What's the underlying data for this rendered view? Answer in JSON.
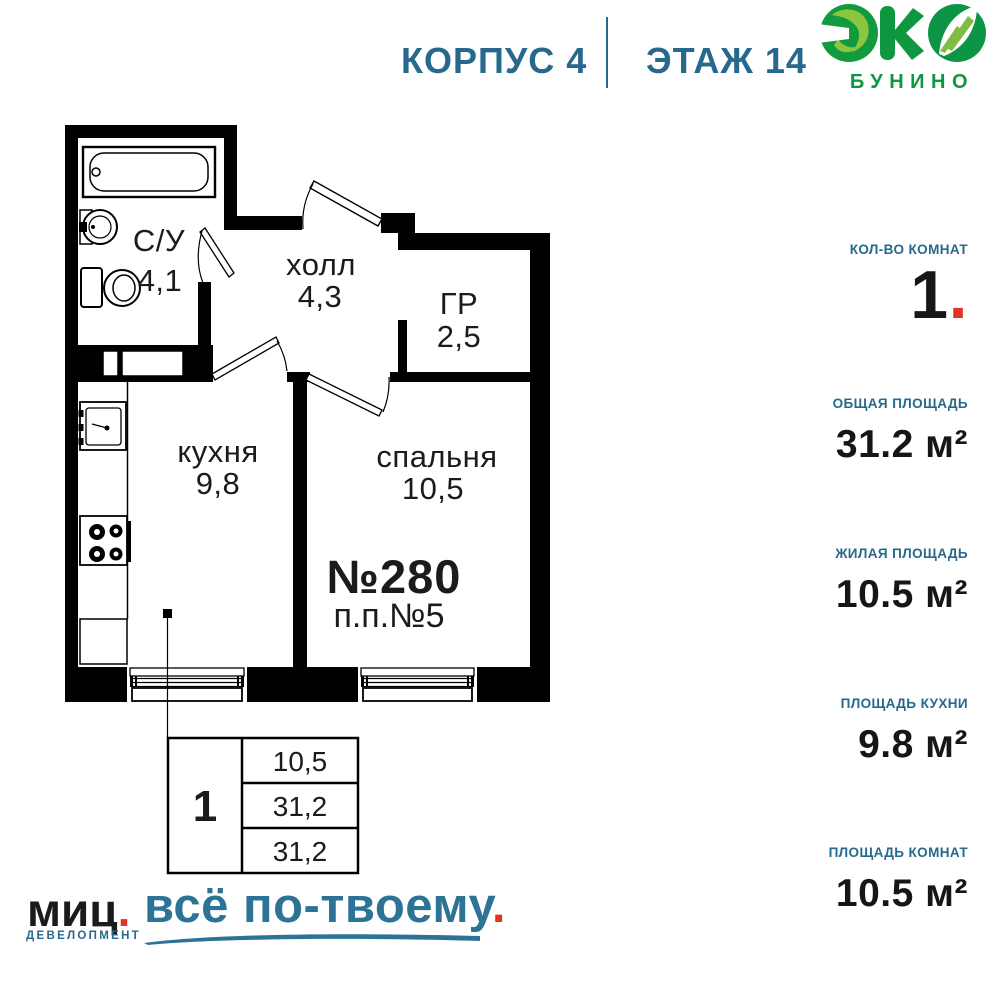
{
  "header": {
    "building": "КОРПУС 4",
    "floor": "ЭТАЖ 14"
  },
  "logo": {
    "emblem": "eco-leaves-emblem",
    "name": "БУНИНО"
  },
  "plan": {
    "rooms": [
      {
        "name": "С/У",
        "area": "4,1"
      },
      {
        "name": "холл",
        "area": "4,3"
      },
      {
        "name": "ГР",
        "area": "2,5"
      },
      {
        "name": "кухня",
        "area": "9,8"
      },
      {
        "name": "спальня",
        "area": "10,5"
      }
    ],
    "apartment_number": "№280",
    "plan_position": "п.п.№5"
  },
  "info_table": {
    "rooms_count": "1",
    "values": [
      "10,5",
      "31,2",
      "31,2"
    ]
  },
  "stats": [
    {
      "label": "КОЛ-ВО КОМНАТ",
      "value": "1",
      "suffix": "."
    },
    {
      "label": "ОБЩАЯ ПЛОЩАДЬ",
      "value": "31.2 м²"
    },
    {
      "label": "ЖИЛАЯ ПЛОЩАДЬ",
      "value": "10.5 м²"
    },
    {
      "label": "ПЛОЩАДЬ КУХНИ",
      "value": "9.8 м²"
    },
    {
      "label": "ПЛОЩАДЬ КОМНАТ",
      "value": "10.5 м²"
    }
  ],
  "footer": {
    "brand": "миц",
    "brand_dot": ".",
    "brand_sub": "ДЕВЕЛОПМЕНТ",
    "tagline": "всё по-твоему",
    "tagline_dot": "."
  },
  "colors": {
    "teal": "#27698C",
    "teal_bright": "#2C7396",
    "red": "#E13327",
    "green_dark": "#129B3E",
    "green_mid": "#0F9740",
    "green_light": "#8CC63E",
    "wall": "#000000"
  }
}
